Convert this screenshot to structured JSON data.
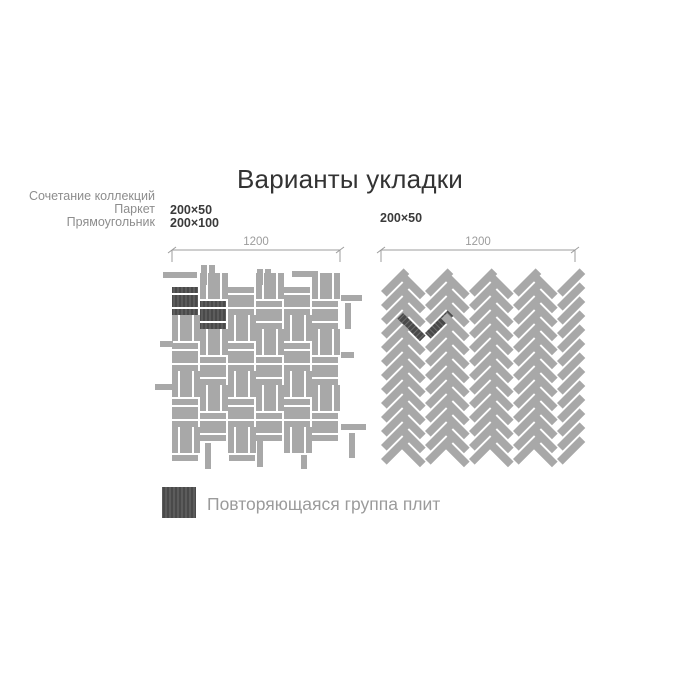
{
  "title": "Варианты укладки",
  "left_diagram": {
    "collection_lines": [
      "Сочетание коллекций",
      "Паркет",
      "Прямоугольник"
    ],
    "sizes": [
      "200×50",
      "200×100"
    ],
    "dimension_label": "1200",
    "pattern": {
      "type": "basketweave",
      "tile_sizes_mm": [
        "200×50",
        "200×100"
      ],
      "origin": [
        172,
        287
      ],
      "cell": 28,
      "cols": 6,
      "rows": 6,
      "gap": 2,
      "thin": 6,
      "thick": 12,
      "odd_col_raise": 14,
      "highlights": [
        [
          0,
          0
        ],
        [
          1,
          1
        ]
      ],
      "edge_tiles": [
        [
          163,
          272,
          34,
          6
        ],
        [
          201,
          265,
          6,
          20
        ],
        [
          209,
          265,
          6,
          20
        ],
        [
          257,
          269,
          6,
          16
        ],
        [
          265,
          269,
          6,
          16
        ],
        [
          292,
          271,
          26,
          6
        ],
        [
          341,
          295,
          21,
          6
        ],
        [
          345,
          303,
          6,
          26
        ],
        [
          341,
          352,
          13,
          6
        ],
        [
          341,
          424,
          25,
          6
        ],
        [
          349,
          433,
          6,
          25
        ],
        [
          160,
          341,
          13,
          6
        ],
        [
          155,
          384,
          17,
          6
        ],
        [
          172,
          455,
          26,
          6
        ],
        [
          205,
          443,
          6,
          26
        ],
        [
          229,
          455,
          26,
          6
        ],
        [
          257,
          441,
          6,
          26
        ],
        [
          301,
          455,
          6,
          14
        ]
      ]
    }
  },
  "right_diagram": {
    "size": "200×50",
    "dimension_label": "1200",
    "pattern": {
      "type": "herringbone",
      "tile_size_mm": "200×50",
      "origin": [
        381,
        271
      ],
      "pair": 44,
      "half": 22,
      "step": 14,
      "len": 32,
      "wid": 8,
      "slash_drop": 20,
      "rows": 13,
      "cols_backslash": 4,
      "cols_slash": 5,
      "highlight_backslash": [
        0,
        3
      ],
      "highlight_slash": [
        1,
        3
      ]
    }
  },
  "dimensions": {
    "left_line": [
      172,
      340
    ],
    "right_line": [
      381,
      575
    ],
    "line_y": 250,
    "tick_drop": 12
  },
  "legend": {
    "label": "Повторяющаяся группа плит",
    "swatch": [
      162,
      487,
      34,
      31
    ]
  },
  "colors": {
    "tile": "#a8a8a8",
    "tile_dark": "#4a4a4a",
    "hatch": "#6e6e6e",
    "dim": "#9c9c9c",
    "label_gray": "#8d8d8d",
    "title": "#333333",
    "size_label": "#3a3a3a",
    "legend_text": "#9b9b9b"
  }
}
